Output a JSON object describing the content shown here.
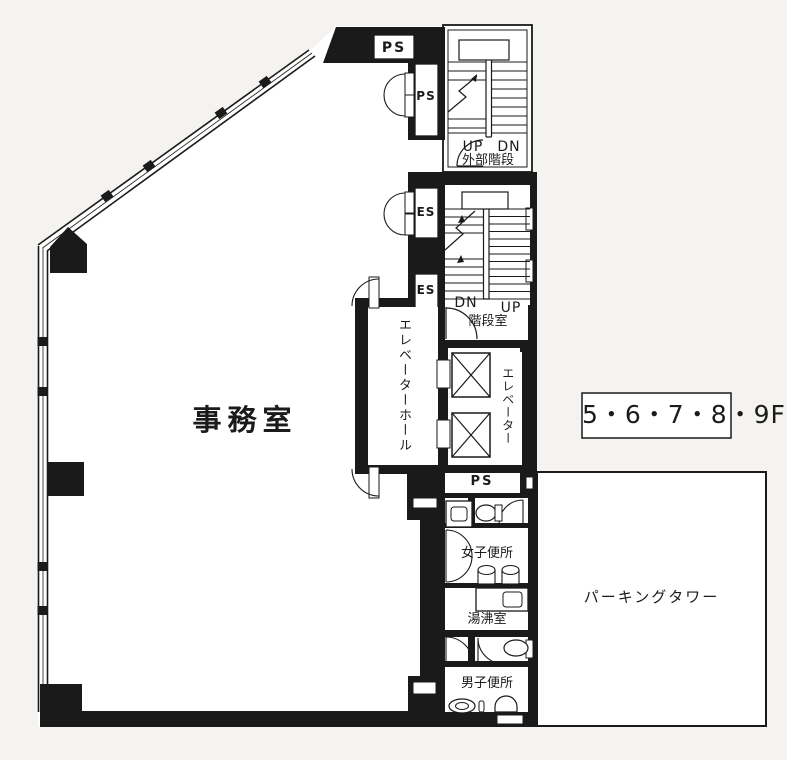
{
  "plan": {
    "office": {
      "label": "事務室"
    },
    "floor_badge": "5・6・7・8・9F",
    "parking": {
      "label": "パーキングタワー"
    },
    "core": {
      "ps_top": "PS",
      "ps_shaft": "PS",
      "external_stair": {
        "up": "UP",
        "dn": "DN",
        "label": "外部階段"
      },
      "es_upper": "ES",
      "es_lower": "ES",
      "internal_stair": {
        "dn": "DN",
        "up": "UP",
        "label": "階段室"
      },
      "elevator_hall": {
        "label": "エレベーターホール"
      },
      "elevator": {
        "label": "エレベーター"
      },
      "ps_lower": "PS",
      "womens_toilet": {
        "label": "女子便所"
      },
      "kitchenette": {
        "label": "湯沸室"
      },
      "mens_toilet": {
        "label": "男子便所"
      }
    },
    "colors": {
      "wall": "#1a1a1a",
      "room": "#ffffff",
      "background": "#f4f3f0"
    }
  }
}
